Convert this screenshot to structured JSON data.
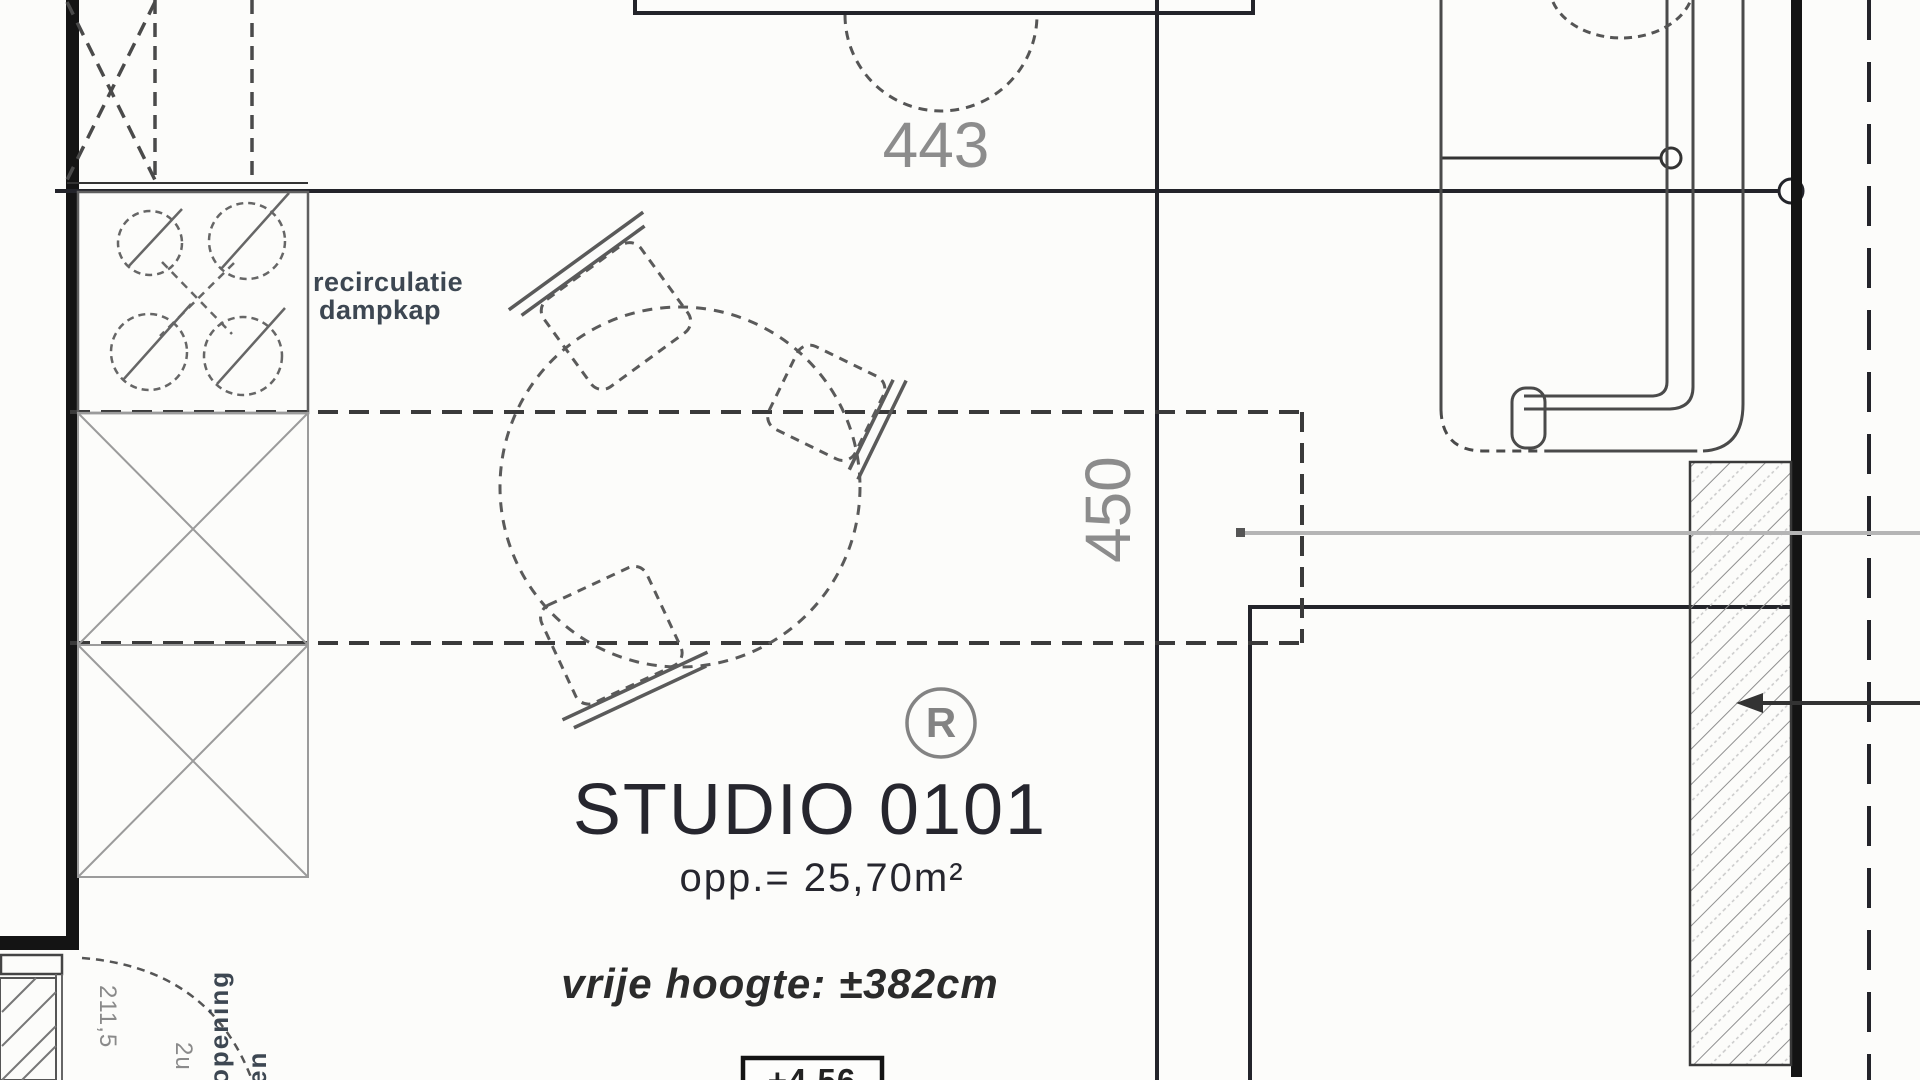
{
  "room": {
    "name": "STUDIO 0101",
    "area": "opp.= 25,70m²",
    "free_height": "vrije hoogte: ±382cm",
    "level": "+4,56",
    "ref_marker": "R"
  },
  "dimensions": {
    "width_cm": "443",
    "depth_cm": "450"
  },
  "labels": {
    "hood_line1": "recirculatie",
    "hood_line2": "dampkap",
    "door_note": "opening",
    "door_note2": "en",
    "door_dim": "211,5",
    "door_dim2": "2u"
  },
  "colors": {
    "wall_black": "#141414",
    "line_dark": "#23242a",
    "line_mid": "#4a4a4a",
    "line_gray": "#9b9b9b",
    "leader_gray": "#b5b5b5",
    "text_dark": "#26262e",
    "text_gray": "#8c8c8c",
    "label_navy": "#3d4752"
  }
}
